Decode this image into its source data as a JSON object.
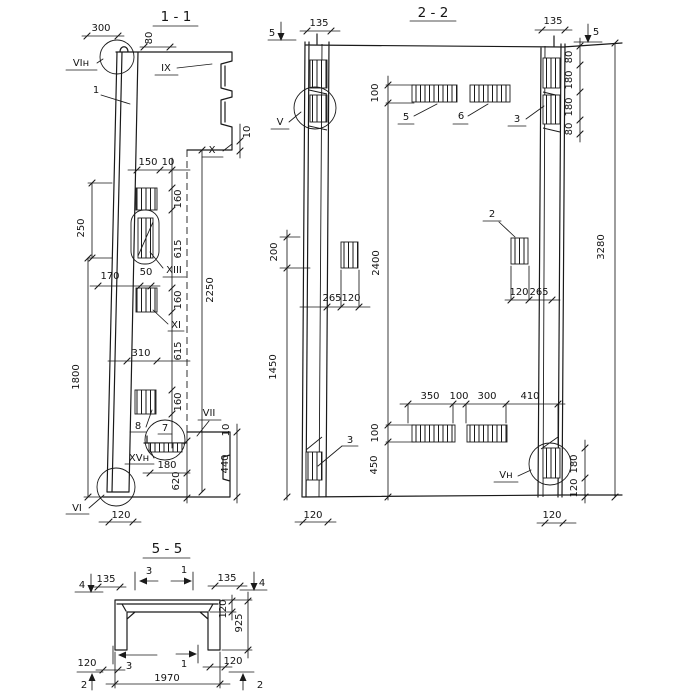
{
  "style": {
    "ink": "#1a1a1a",
    "paper": "#ffffff"
  },
  "section_1_1": {
    "title": "1 - 1",
    "callouts": {
      "node_vi_top": "VIн",
      "detail_ix": "IX",
      "detail_x": "X",
      "detail_xiii": "XIII",
      "detail_xi": "XI",
      "detail_vii": "VII",
      "detail_xv_n": "XVн",
      "node_vi_bottom": "VI",
      "item_1": "1",
      "item_8": "8",
      "item_7": "7"
    },
    "dims": {
      "w300": "300",
      "w80": "80",
      "w150": "150",
      "w10_top": "10",
      "w10_x": "10",
      "h160_1": "160",
      "h615_1": "615",
      "h160_2": "160",
      "h615_2": "615",
      "h160_3": "160",
      "h250": "250",
      "w170": "170",
      "w50": "50",
      "w310": "310",
      "h1800": "1800",
      "h2250": "2250",
      "w180": "180",
      "h620": "620",
      "h440": "440",
      "w10_vii": "10",
      "w120": "120"
    }
  },
  "section_2_2": {
    "title": "2 - 2",
    "cut_markers": {
      "five_left": "5",
      "five_right": "5"
    },
    "callouts": {
      "detail_v": "V",
      "detail_v_n": "Vн",
      "item_2": "2",
      "item_3_top": "3",
      "item_3_bottom": "3",
      "item_5": "5",
      "item_6": "6"
    },
    "dims": {
      "w135_left": "135",
      "w135_right": "135",
      "h100_top": "100",
      "h80_a": "80",
      "h180_a": "180",
      "h180_b": "180",
      "h80_b": "80",
      "h200": "200",
      "h1450": "1450",
      "h2400": "2400",
      "h3280": "3280",
      "w265_left": "265",
      "w120_left": "120",
      "w120_mid": "120",
      "w265_mid": "265",
      "w350": "350",
      "w100": "100",
      "w300": "300",
      "w410": "410",
      "h100_bottom": "100",
      "h450": "450",
      "h180_br": "180",
      "h120_br": "120",
      "w120_bottom_left": "120",
      "w120_bottom_right": "120"
    }
  },
  "section_5_5": {
    "title": "5 - 5",
    "cut_markers": {
      "four_left": "4",
      "four_right": "4",
      "three_top": "3",
      "one_top": "1",
      "three_bottom": "3",
      "one_bottom": "1",
      "two_left": "2",
      "two_right": "2"
    },
    "dims": {
      "w135_left": "135",
      "w135_right": "135",
      "t120_flange": "120",
      "h925": "925",
      "w120_left": "120",
      "w120_right": "120",
      "w1970": "1970"
    }
  }
}
